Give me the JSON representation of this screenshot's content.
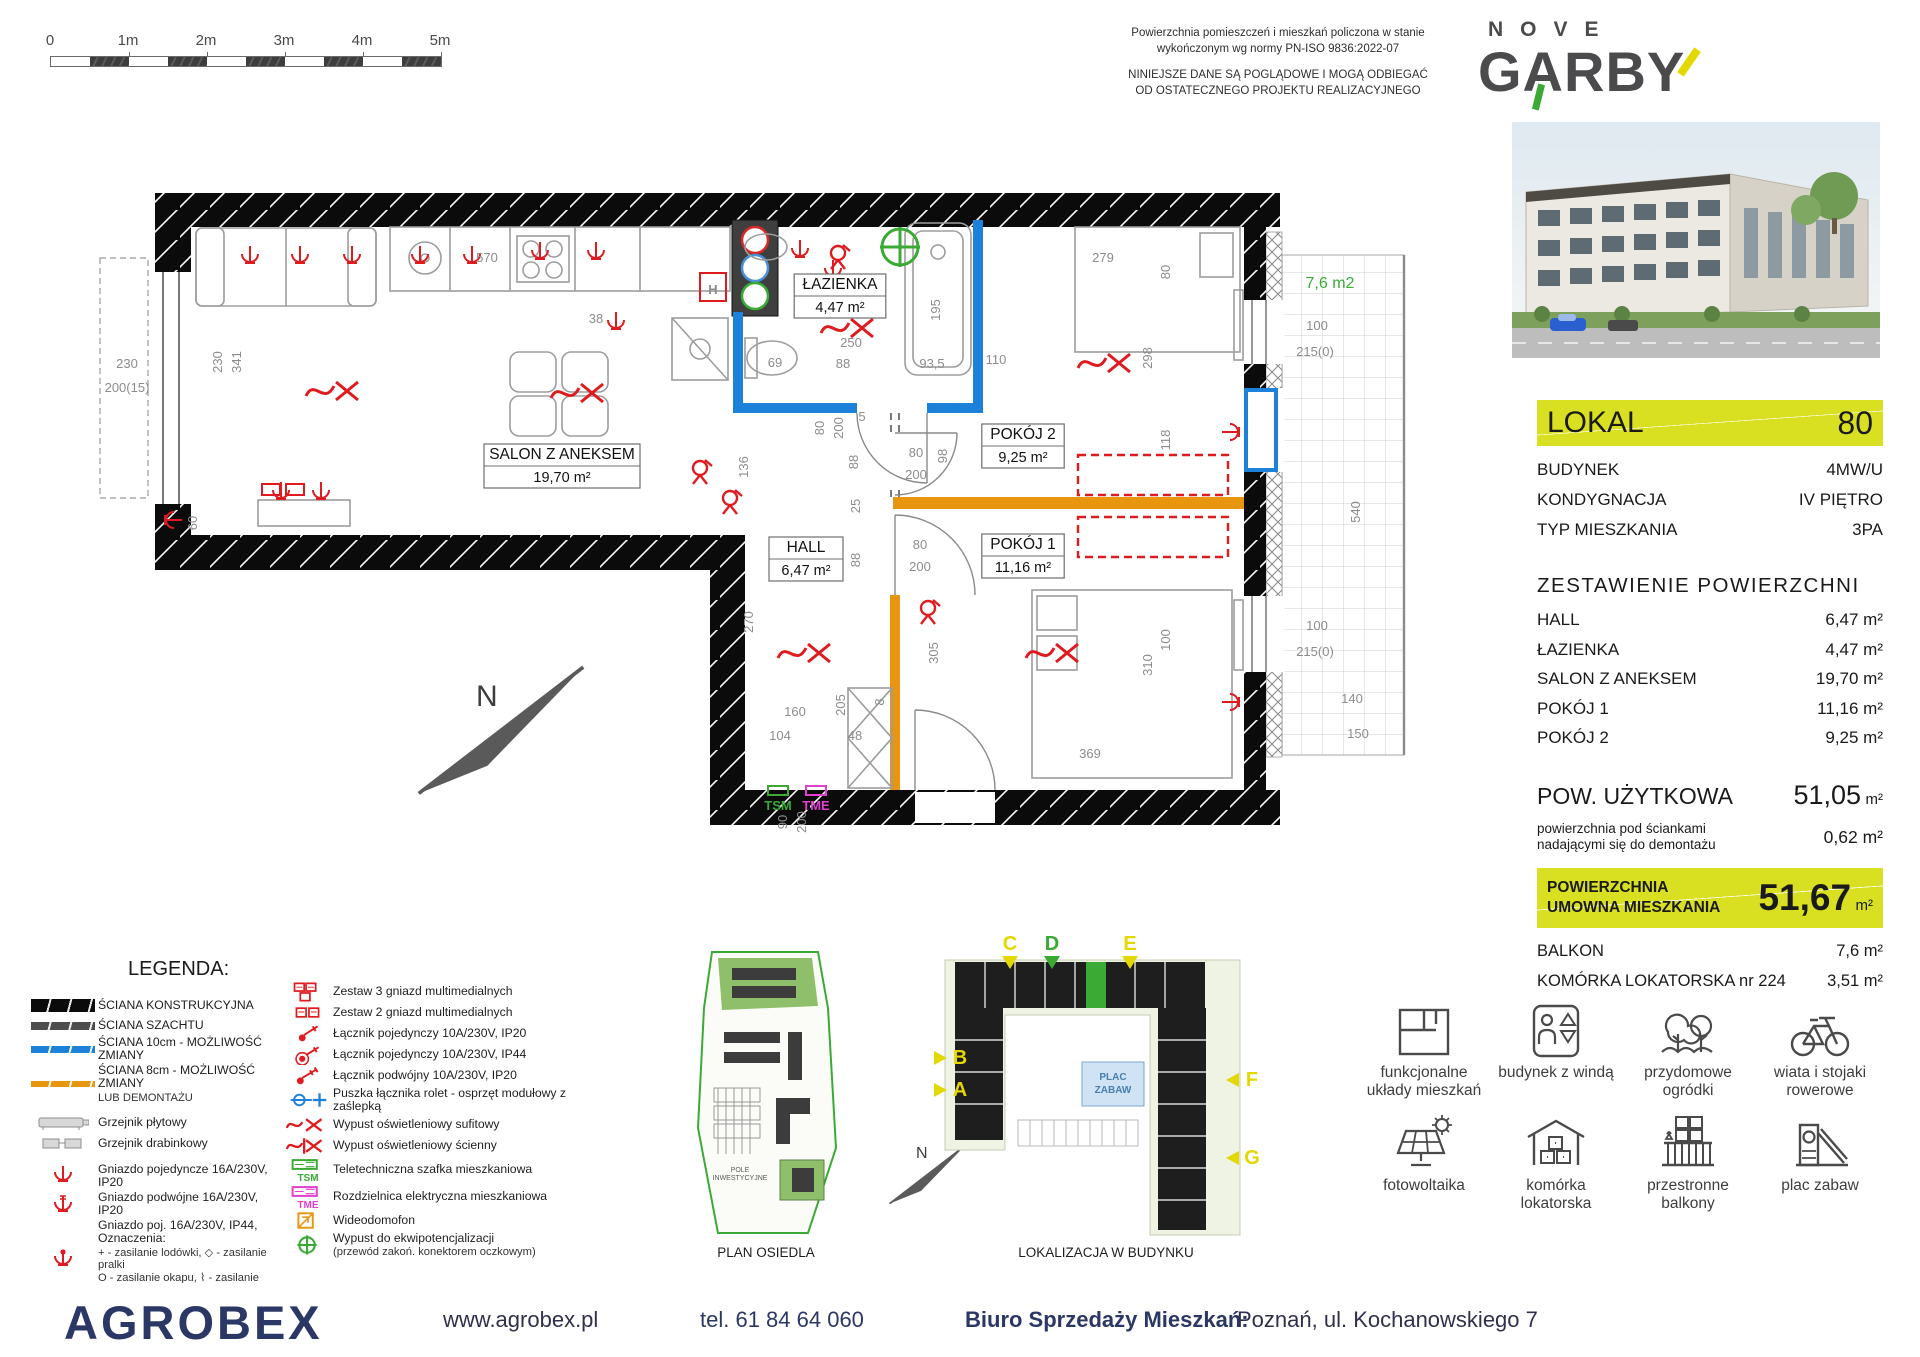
{
  "scalebar": {
    "labels": [
      "0",
      "1m",
      "2m",
      "3m",
      "4m",
      "5m"
    ]
  },
  "notes": {
    "measure": "Powierzchnia pomieszczeń i mieszkań policzona w stanie wykończonym wg normy PN-ISO 9836:2022-07",
    "disclaimer": "NINIEJSZE DANE SĄ POGLĄDOWE I MOGĄ ODBIEGAĆ OD OSTATECZNEGO PROJEKTU REALIZACYJNEGO"
  },
  "brand": {
    "line1": "NOVE",
    "line2": "GARBY"
  },
  "unit": {
    "lokal_label": "LOKAL",
    "lokal_number": "80",
    "attributes": [
      {
        "label": "BUDYNEK",
        "value": "4MW/U"
      },
      {
        "label": "KONDYGNACJA",
        "value": "IV PIĘTRO"
      },
      {
        "label": "TYP MIESZKANIA",
        "value": "3PA"
      }
    ],
    "surfaces_title": "ZESTAWIENIE POWIERZCHNI",
    "surfaces": [
      {
        "label": "HALL",
        "value": "6,47 m²"
      },
      {
        "label": "ŁAZIENKA",
        "value": "4,47 m²"
      },
      {
        "label": "SALON Z ANEKSEM",
        "value": "19,70 m²"
      },
      {
        "label": "POKÓJ 1",
        "value": "11,16 m²"
      },
      {
        "label": "POKÓJ 2",
        "value": "9,25 m²"
      }
    ],
    "usable_label": "POW. UŻYTKOWA",
    "usable_value": "51,05",
    "usable_unit": "m²",
    "demolition_note_l1": "powierzchnia pod ściankami",
    "demolition_note_l2": "nadającymi się do demontażu",
    "demolition_value": "0,62 m²",
    "contract_label_l1": "POWIERZCHNIA",
    "contract_label_l2": "UMOWNA MIESZKANIA",
    "contract_value": "51,67",
    "contract_unit": "m²",
    "extras": [
      {
        "label": "BALKON",
        "value": "7,6 m²"
      },
      {
        "label": "KOMÓRKA LOKATORSKA nr 224",
        "value": "3,51 m²"
      }
    ]
  },
  "features": [
    {
      "icon": "floorplan-icon",
      "label": "funkcjonalne układy mieszkań"
    },
    {
      "icon": "elevator-icon",
      "label": "budynek z windą"
    },
    {
      "icon": "garden-icon",
      "label": "przydomowe ogródki"
    },
    {
      "icon": "bike-icon",
      "label": "wiata i stojaki rowerowe"
    },
    {
      "icon": "solar-icon",
      "label": "fotowoltaika"
    },
    {
      "icon": "storage-icon",
      "label": "komórka lokatorska"
    },
    {
      "icon": "balcony-icon",
      "label": "przestronne balkony"
    },
    {
      "icon": "playground-icon",
      "label": "plac zabaw"
    }
  ],
  "legend": {
    "title": "LEGENDA:",
    "col1": [
      {
        "icon": "wall-black",
        "label": "ŚCIANA KONSTRUKCYJNA"
      },
      {
        "icon": "wall-gray",
        "label": "ŚCIANA SZACHTU"
      },
      {
        "icon": "wall-blue",
        "label": "ŚCIANA 10cm - MOŻLIWOŚĆ ZMIANY"
      },
      {
        "icon": "wall-orange",
        "label": "ŚCIANA 8cm - MOŻLIWOŚĆ ZMIANY",
        "label2": "LUB DEMONTAŻU"
      },
      {
        "icon": "radiator-panel",
        "label": "Grzejnik płytowy",
        "gap": true
      },
      {
        "icon": "radiator-ladder",
        "label": "Grzejnik drabinkowy"
      },
      {
        "icon": "socket-single",
        "label": "Gniazdo pojedyncze 16A/230V, IP20",
        "gap": true
      },
      {
        "icon": "socket-double",
        "label": "Gniazdo podwójne 16A/230V, IP20"
      },
      {
        "icon": "socket-ip44",
        "label": "Gniazdo poj. 16A/230V, IP44, Oznaczenia:",
        "sub": [
          "+  - zasilanie lodówki,   ◇  - zasilanie pralki",
          "O  - zasilanie okapu,   ⌇  - zasilanie zmywarki"
        ]
      },
      {
        "icon": "socket-power",
        "label": "Gniazdo siłowe 16A/400V, IP44",
        "gap": true
      }
    ],
    "col2": [
      {
        "icon": "media-3",
        "label": "Zestaw 3 gniazd multimedialnych"
      },
      {
        "icon": "media-2",
        "label": "Zestaw 2 gniazd multimedialnych"
      },
      {
        "icon": "switch-single",
        "label": "Łącznik pojedynczy 10A/230V, IP20"
      },
      {
        "icon": "switch-single-44",
        "label": "Łącznik pojedynczy 10A/230V, IP44"
      },
      {
        "icon": "switch-double",
        "label": "Łącznik podwójny 10A/230V, IP20"
      },
      {
        "icon": "roller-box",
        "label": "Puszka łącznika rolet - osprzęt modułowy z zaślepką"
      },
      {
        "icon": "light-ceiling",
        "label": "Wypust oświetleniowy sufitowy"
      },
      {
        "icon": "light-wall",
        "label": "Wypust oświetleniowy ścienny"
      },
      {
        "icon": "tsm-box",
        "tag": "TSM",
        "label": "Teletechniczna szafka mieszkaniowa"
      },
      {
        "icon": "tme-box",
        "tag": "TME",
        "label": "Rozdzielnica elektryczna mieszkaniowa"
      },
      {
        "icon": "intercom",
        "label": "Wideodomofon"
      },
      {
        "icon": "equipotential",
        "label": "Wypust do ekwipotencjalizacji",
        "sub": [
          "(przewód zakoń. konektorem oczkowym)"
        ]
      }
    ]
  },
  "maps": {
    "estate": {
      "label": "PLAN OSIEDLA",
      "field_note": "POLE INWESTYCYJNE"
    },
    "building": {
      "label": "LOKALIZACJA  W BUDYNKU",
      "playground": "PLAC ZABAW",
      "markers": [
        {
          "id": "C",
          "x": 1010,
          "y": 950,
          "dir": "down",
          "color": "#e3d800"
        },
        {
          "id": "D",
          "x": 1052,
          "y": 950,
          "dir": "down",
          "color": "#3aaa35"
        },
        {
          "id": "E",
          "x": 1130,
          "y": 950,
          "dir": "down",
          "color": "#e3d800"
        },
        {
          "id": "B",
          "x": 960,
          "y": 1064,
          "dir": "right",
          "color": "#e3d800"
        },
        {
          "id": "A",
          "x": 960,
          "y": 1096,
          "dir": "right",
          "color": "#e3d800"
        },
        {
          "id": "F",
          "x": 1252,
          "y": 1086,
          "dir": "left",
          "color": "#e3d800"
        },
        {
          "id": "G",
          "x": 1252,
          "y": 1164,
          "dir": "left",
          "color": "#e3d800"
        }
      ]
    }
  },
  "plan": {
    "north": "N",
    "balcony_area": "7,6 m2",
    "tsm": "TSM",
    "tme": "TME",
    "rooms": [
      {
        "name": "SALON Z ANEKSEM",
        "area": "19,70 m²",
        "x": 562,
        "y": 466
      },
      {
        "name": "ŁAZIENKA",
        "area": "4,47 m²",
        "x": 840,
        "y": 296
      },
      {
        "name": "POKÓJ 2",
        "area": "9,25 m²",
        "x": 1023,
        "y": 446
      },
      {
        "name": "POKÓJ 1",
        "area": "11,16 m²",
        "x": 1023,
        "y": 556
      },
      {
        "name": "HALL",
        "area": "6,47 m²",
        "x": 806,
        "y": 559
      }
    ],
    "symbols": [
      {
        "t": "H",
        "x": 713,
        "y": 294
      }
    ],
    "dims": [
      {
        "t": "570",
        "x": 487,
        "y": 262
      },
      {
        "t": "279",
        "x": 1103,
        "y": 262
      },
      {
        "t": "80",
        "x": 1170,
        "y": 272,
        "r": 90
      },
      {
        "t": "230",
        "x": 222,
        "y": 362,
        "r": 90
      },
      {
        "t": "341",
        "x": 241,
        "y": 362,
        "r": 90
      },
      {
        "t": "230",
        "x": 127,
        "y": 368
      },
      {
        "t": "200(15)",
        "x": 127,
        "y": 392
      },
      {
        "t": "60",
        "x": 197,
        "y": 523,
        "r": 90
      },
      {
        "t": "38",
        "x": 596,
        "y": 323
      },
      {
        "t": "69",
        "x": 775,
        "y": 367
      },
      {
        "t": "250",
        "x": 851,
        "y": 347
      },
      {
        "t": "88",
        "x": 843,
        "y": 368
      },
      {
        "t": "93,5",
        "x": 932,
        "y": 368
      },
      {
        "t": "110",
        "x": 996,
        "y": 364
      },
      {
        "t": "195",
        "x": 940,
        "y": 310,
        "r": 90
      },
      {
        "t": "298",
        "x": 1152,
        "y": 358,
        "r": 90
      },
      {
        "t": "118",
        "x": 1170,
        "y": 440,
        "r": 90
      },
      {
        "t": "80",
        "x": 824,
        "y": 428,
        "r": 90
      },
      {
        "t": "200",
        "x": 843,
        "y": 428,
        "r": 90
      },
      {
        "t": "5",
        "x": 862,
        "y": 421
      },
      {
        "t": "88",
        "x": 858,
        "y": 462,
        "r": 90
      },
      {
        "t": "136",
        "x": 748,
        "y": 467,
        "r": 90
      },
      {
        "t": "80",
        "x": 916,
        "y": 457
      },
      {
        "t": "200",
        "x": 916,
        "y": 479
      },
      {
        "t": "98",
        "x": 947,
        "y": 456,
        "r": 90
      },
      {
        "t": "25",
        "x": 860,
        "y": 506,
        "r": 90
      },
      {
        "t": "88",
        "x": 860,
        "y": 560,
        "r": 90
      },
      {
        "t": "80",
        "x": 920,
        "y": 549
      },
      {
        "t": "200",
        "x": 920,
        "y": 571
      },
      {
        "t": "270",
        "x": 753,
        "y": 622,
        "r": 90
      },
      {
        "t": "205",
        "x": 845,
        "y": 705,
        "r": 90
      },
      {
        "t": "305",
        "x": 938,
        "y": 653,
        "r": 90
      },
      {
        "t": "310",
        "x": 1152,
        "y": 665,
        "r": 90
      },
      {
        "t": "100",
        "x": 1170,
        "y": 640,
        "r": 90
      },
      {
        "t": "160",
        "x": 795,
        "y": 716
      },
      {
        "t": "104",
        "x": 780,
        "y": 740
      },
      {
        "t": "48",
        "x": 855,
        "y": 740
      },
      {
        "t": "8",
        "x": 884,
        "y": 702,
        "r": 90
      },
      {
        "t": "369",
        "x": 1090,
        "y": 758
      },
      {
        "t": "90",
        "x": 787,
        "y": 822,
        "r": 90
      },
      {
        "t": "200",
        "x": 806,
        "y": 822,
        "r": 90
      },
      {
        "t": "100",
        "x": 1317,
        "y": 330
      },
      {
        "t": "215(0)",
        "x": 1315,
        "y": 356
      },
      {
        "t": "540",
        "x": 1360,
        "y": 512,
        "r": 90
      },
      {
        "t": "100",
        "x": 1317,
        "y": 630
      },
      {
        "t": "215(0)",
        "x": 1315,
        "y": 656
      },
      {
        "t": "140",
        "x": 1352,
        "y": 703
      },
      {
        "t": "150",
        "x": 1358,
        "y": 738
      }
    ]
  },
  "footer": {
    "logo": "AGROBEX",
    "website": "www.agrobex.pl",
    "phone": "tel. 61 84 64 060",
    "office_label": "Biuro Sprzedaży Mieszkań:",
    "office_address": "Poznań, ul. Kochanowskiego 7"
  }
}
